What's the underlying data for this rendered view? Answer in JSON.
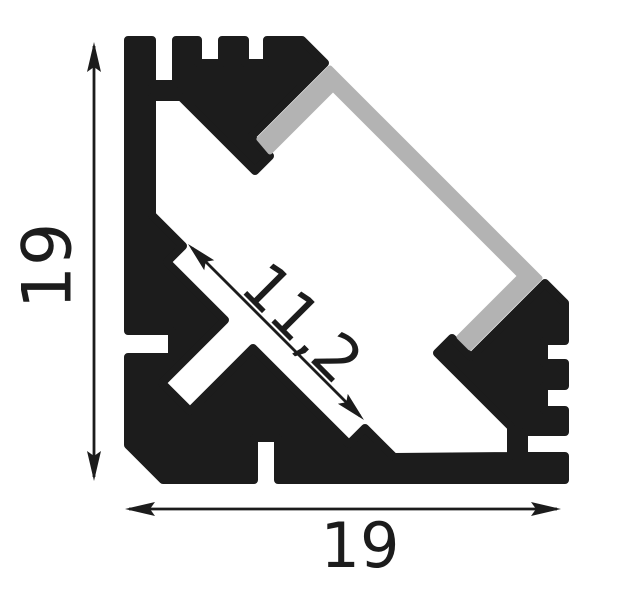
{
  "diagram": {
    "description": "LED aluminium corner profile cross-section technical drawing",
    "dimensions": {
      "height_label": "19",
      "width_label": "19",
      "window_label": "11,2"
    },
    "colors": {
      "profile": "#1c1c1c",
      "diffuser": "#b3b3b3",
      "dimension": "#1c1c1c",
      "background": "#ffffff"
    }
  }
}
